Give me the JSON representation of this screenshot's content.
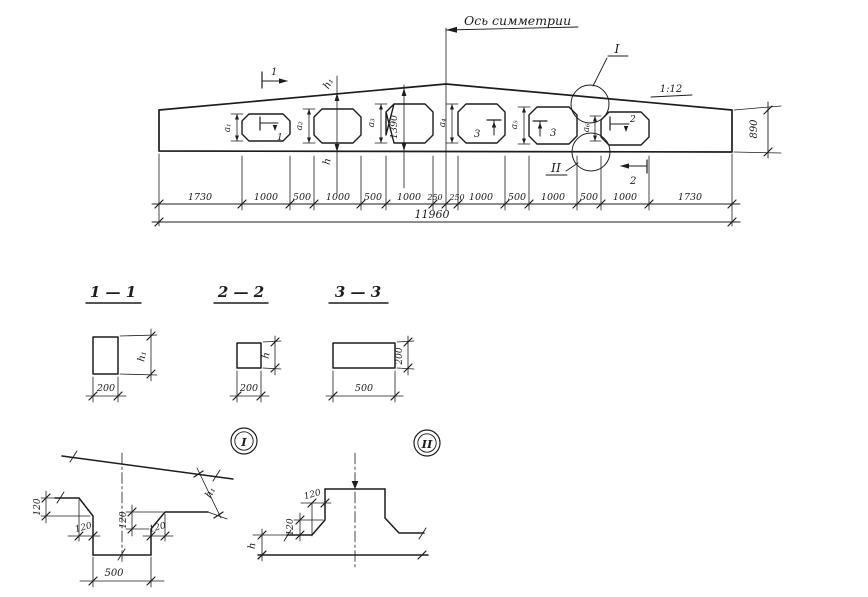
{
  "drawing": {
    "paper_color": "#ffffff",
    "ink_color": "#1d1d1b",
    "axis_label": "Ось симметрии",
    "slope_label": "1:12",
    "marks": {
      "s1": "1",
      "s2": "2",
      "s3": "3"
    },
    "details": {
      "i": "I",
      "ii": "II"
    },
    "dims": {
      "h": "h",
      "h1": "h₁",
      "d120": "120",
      "d200": "200",
      "d500": "500",
      "d890": "890",
      "d1390": "1390",
      "total": "11960"
    },
    "a_dims": [
      "a₁",
      "a₂",
      "a₃",
      "a₄",
      "a₅",
      "a₆"
    ],
    "bottom_dims": [
      "1730",
      "1000",
      "500",
      "1000",
      "500",
      "1000",
      "250",
      "250",
      "1000",
      "500",
      "1000",
      "500",
      "1000",
      "1730"
    ],
    "sections": [
      {
        "title": "1 — 1"
      },
      {
        "title": "2 — 2"
      },
      {
        "title": "3 — 3"
      }
    ]
  }
}
